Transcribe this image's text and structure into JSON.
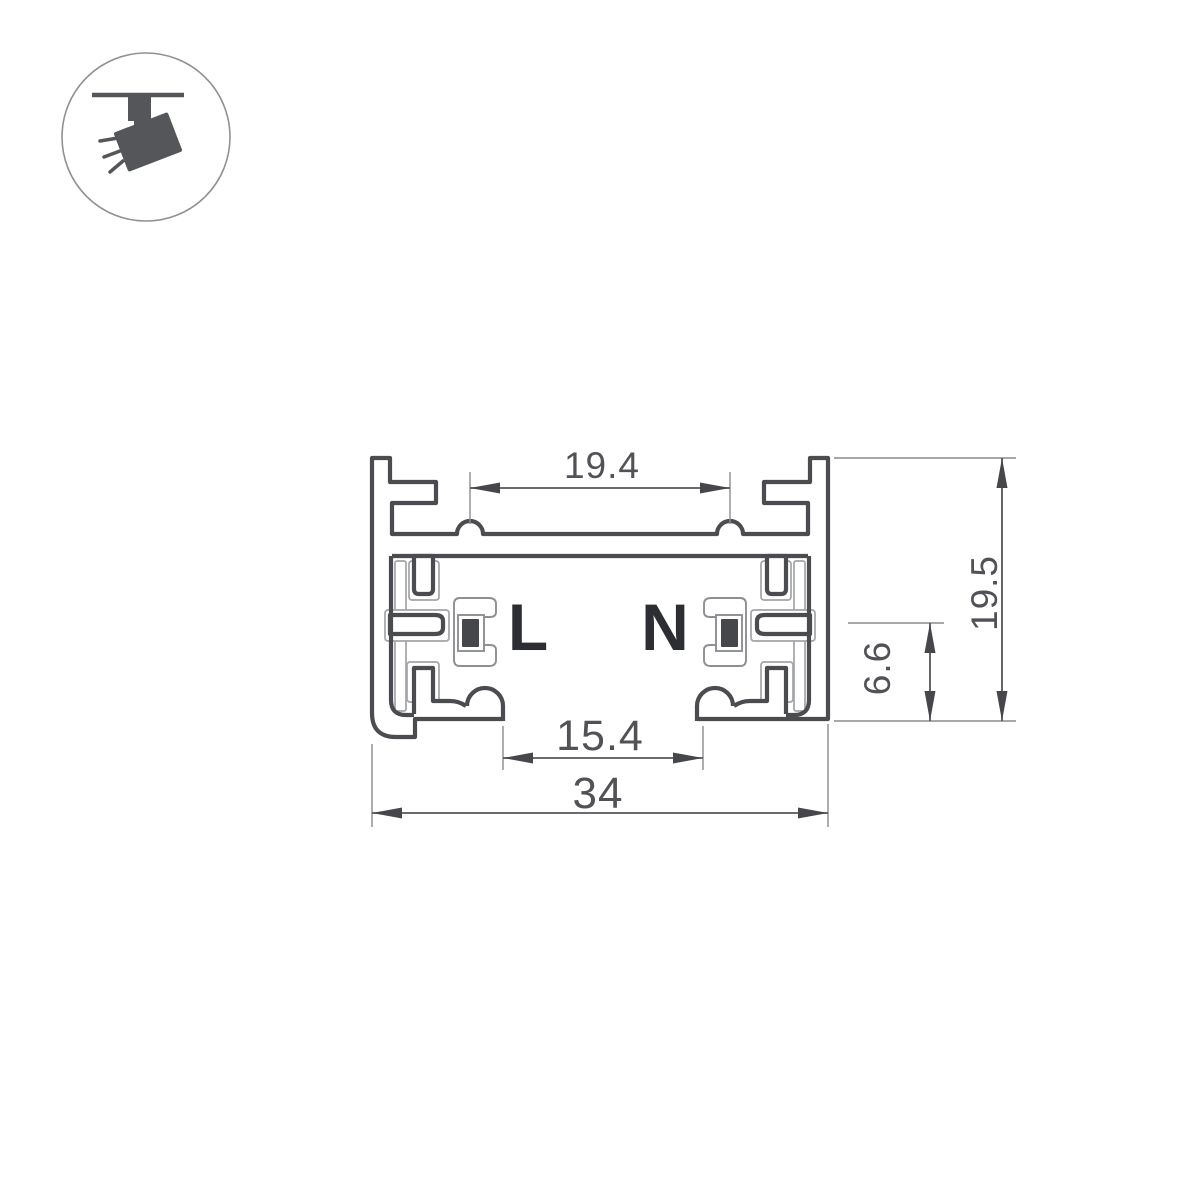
{
  "icon": {
    "semantic": "track-spotlight-icon"
  },
  "labels": {
    "live": "L",
    "neutral": "N"
  },
  "dimensions": {
    "top_groove_spacing": "19.4",
    "bottom_opening": "15.4",
    "overall_width": "34",
    "overall_height": "19.5",
    "conductor_height": "6.6"
  },
  "colors": {
    "background": "#ffffff",
    "outline": "#4b4c50",
    "dimension_line": "#55565a",
    "dimension_text": "#515257",
    "insulator": "#a3a4a8",
    "conductor_fill": "#46474b",
    "label_text": "#2c2e33",
    "icon": "#55565a",
    "icon_circle": "#909196"
  }
}
